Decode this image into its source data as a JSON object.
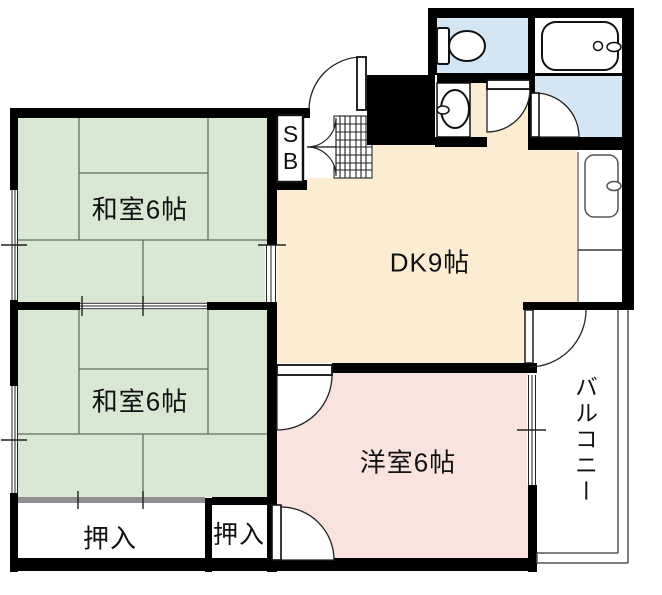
{
  "floorplan": {
    "rooms": {
      "washitsu1": {
        "name": "和室6帖"
      },
      "washitsu2": {
        "name": "和室6帖"
      },
      "dk": {
        "name": "DK9帖"
      },
      "yoshitsu": {
        "name": "洋室6帖"
      },
      "closet_large": {
        "name": "押入"
      },
      "closet_small": {
        "name": "押入"
      },
      "shoe_box": {
        "name": "SB"
      },
      "balcony": {
        "name": "バルコニー"
      }
    },
    "colors": {
      "tatami_room": "#d9e8d2",
      "dining_kitchen": "#fbecd2",
      "western_room": "#f9e3de",
      "wet_area": "#d4e6f4",
      "wall": "#000000"
    }
  }
}
